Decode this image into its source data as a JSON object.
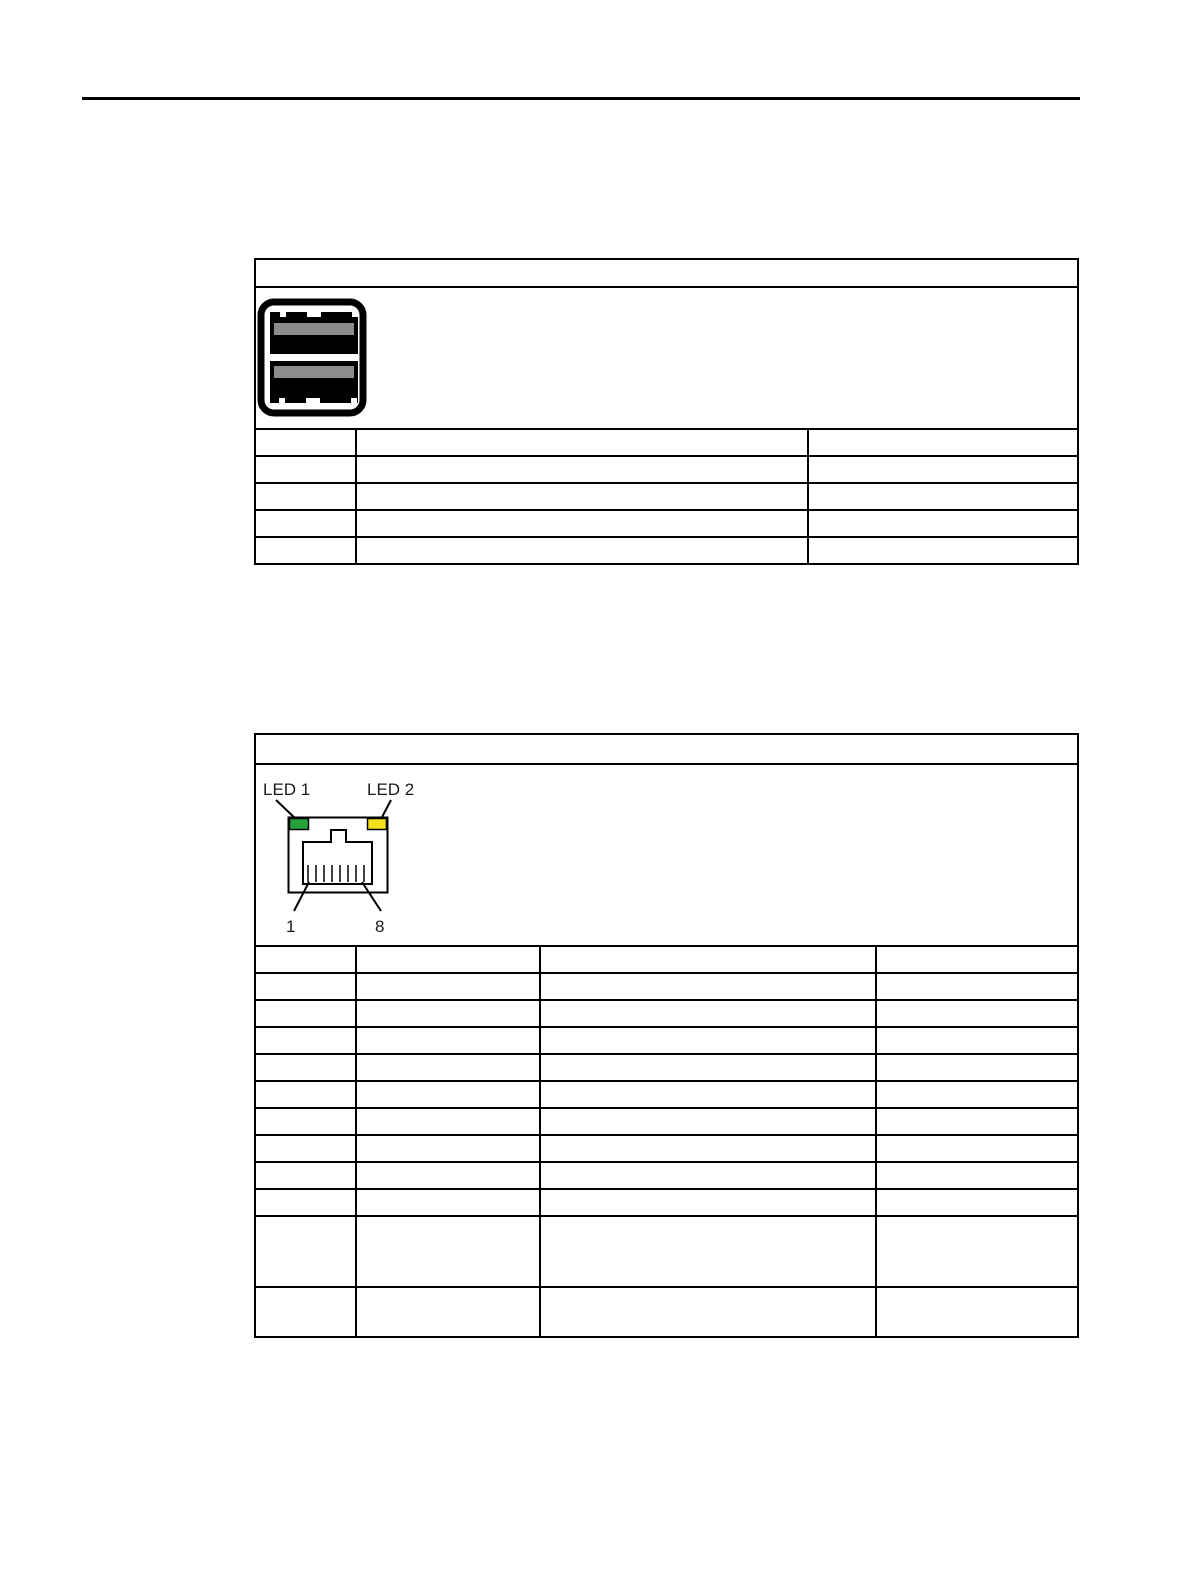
{
  "usb_table": {
    "icon": "usb-dual-port-connector-icon",
    "port_color": "#000000",
    "contact_color": "#8c8c8c",
    "columns": 3,
    "detail_rows": 5
  },
  "ethernet_table": {
    "diagram": "rj45-connector-diagram",
    "led1": {
      "label": "LED 1",
      "color": "#29a23c"
    },
    "led2": {
      "label": "LED 2",
      "color": "#f2e11c"
    },
    "pin_first_label": "1",
    "pin_last_label": "8",
    "columns": 4,
    "detail_rows": 12
  }
}
